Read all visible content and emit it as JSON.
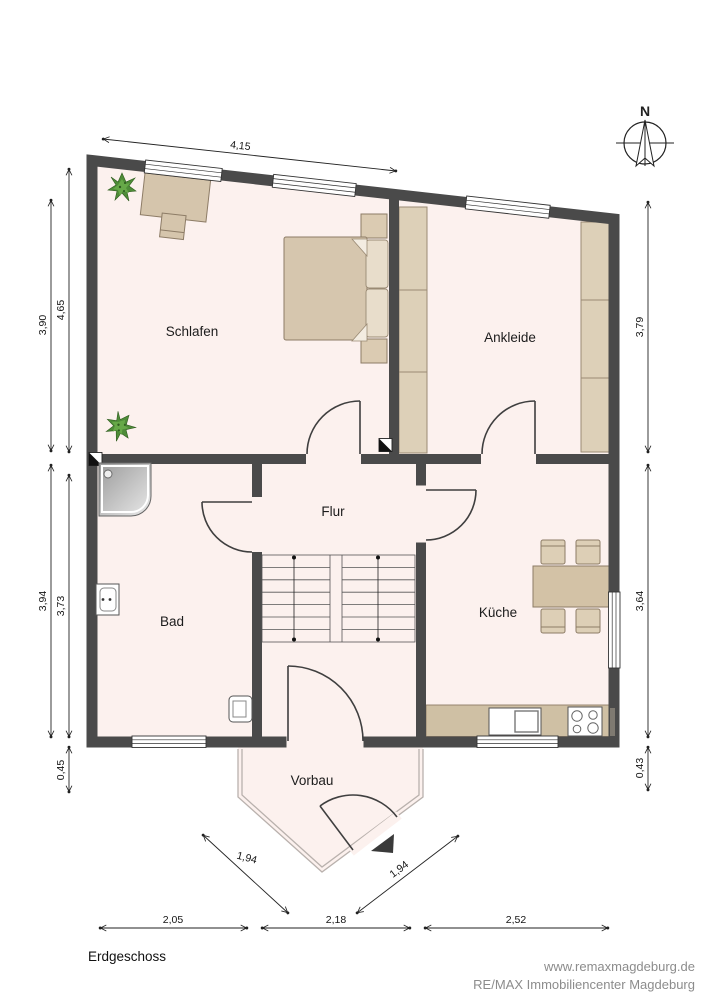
{
  "floor_title": "Erdgeschoss",
  "compass": {
    "north_label": "N"
  },
  "rooms": {
    "schlafen": "Schlafen",
    "ankleide": "Ankleide",
    "flur": "Flur",
    "bad": "Bad",
    "kueche": "Küche",
    "vorbau": "Vorbau"
  },
  "dimensions": {
    "top_width": "4,15",
    "left_outer_upper": "3,90",
    "left_inner_upper": "4,65",
    "left_outer_lower": "3,94",
    "left_inner_lower": "3,73",
    "left_bottom": "0,45",
    "right_upper": "3,79",
    "right_middle": "3,64",
    "right_bottom": "0,43",
    "bottom_left": "2,05",
    "bottom_center": "2,18",
    "bottom_right": "2,52",
    "porch_diag_left": "1,94",
    "porch_diag_right": "1,94"
  },
  "footer": {
    "website": "www.remaxmagdeburg.de",
    "company": "RE/MAX Immobiliencenter Magdeburg"
  },
  "colors": {
    "wall": "#4a4a4a",
    "floor": "#fcf1ee",
    "furniture_fill": "#d6c6ae",
    "furniture_border": "#8d7c66",
    "wardrobe_fill": "#ddd0b8",
    "plant_green": "#4e8c38",
    "dim_line": "#222222",
    "footer_text": "#8c8c8c"
  }
}
